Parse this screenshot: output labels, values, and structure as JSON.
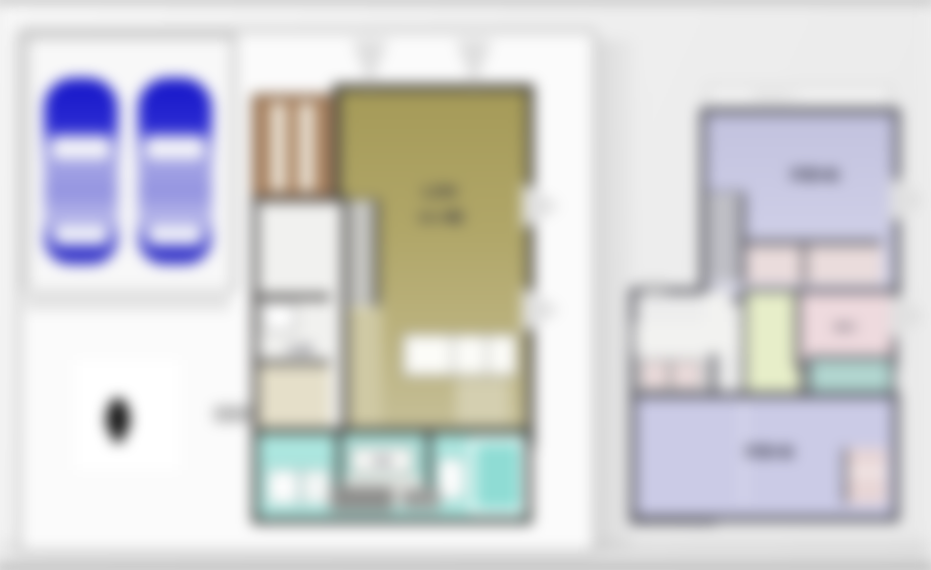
{
  "plan": {
    "floor1": {
      "garage": {
        "car_count": 2,
        "car_color": "#2222cc"
      },
      "deck_color": "#a8815f",
      "ldk_floor_color": "#b0a668",
      "wet_area_color": "#ace6df",
      "ldk_label_line1": "LDK",
      "ldk_label_line2": "16.5帖",
      "entrance_label": "玄関",
      "vanity_label": "洗面"
    },
    "floor2": {
      "floor_color": "#cdcde6",
      "closet_color": "#eadcdc",
      "balcony_color": "#b2d6d0",
      "stair_landing_color": "#e7eec9",
      "eave_label": "バルコニー",
      "bedroom_top_label": "洋室8帖",
      "bedroom_bottom_label": "洋室6帖",
      "wic_label": "WIC"
    }
  }
}
